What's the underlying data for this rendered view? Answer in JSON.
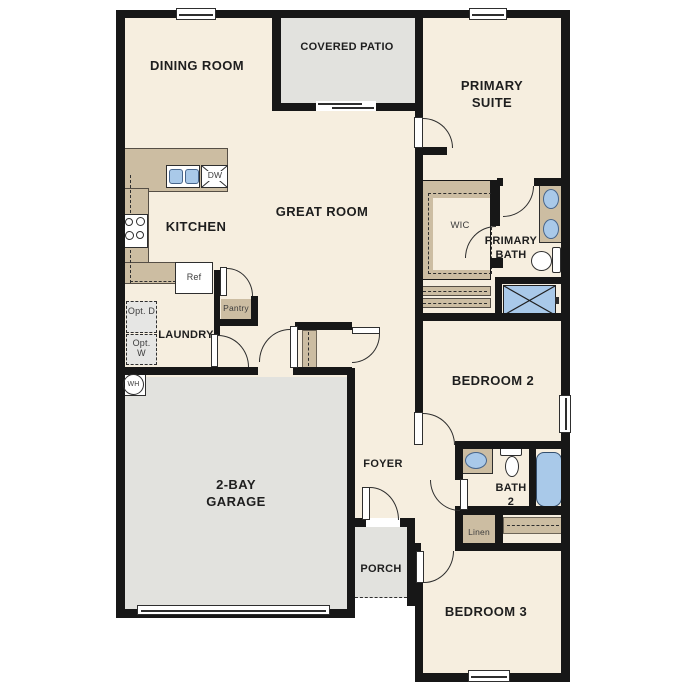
{
  "colors": {
    "floor": "#f6eedf",
    "outdoor": "#e2e2de",
    "wood": "#ccbda2",
    "blue": "#a9c9e9",
    "blue_border": "#47658b",
    "wall": "#171717",
    "line": "#2e2e2e",
    "text": "#1e1e1e",
    "text_small": "#3c3c3c",
    "opt_fill": "#e6e6e4"
  },
  "labels": {
    "dining": "DINING ROOM",
    "covered_patio": "COVERED PATIO",
    "primary_suite": "PRIMARY SUITE",
    "great_room": "GREAT ROOM",
    "kitchen": "KITCHEN",
    "laundry": "LAUNDRY",
    "garage": "2-BAY GARAGE",
    "foyer": "FOYER",
    "porch": "PORCH",
    "bedroom2": "BEDROOM 2",
    "bedroom3": "BEDROOM 3",
    "primary_bath": "PRIMARY BATH",
    "bath2": "BATH 2",
    "wic": "WIC",
    "pantry": "Pantry",
    "linen": "Linen"
  },
  "fixtures": {
    "ref": "Ref",
    "dishwasher": "DW",
    "optional_dryer": "Opt. D",
    "optional_washer": "Opt. W",
    "water_heater": "WH"
  }
}
